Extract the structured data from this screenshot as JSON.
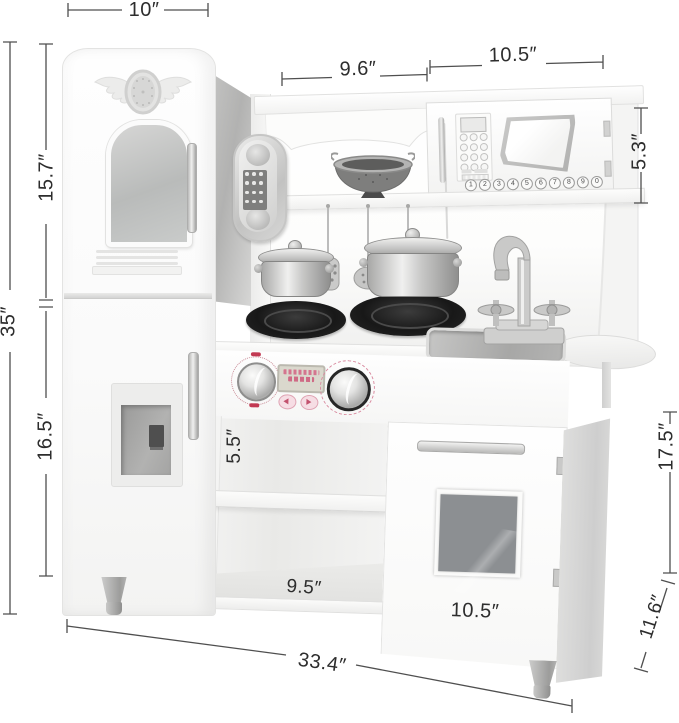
{
  "dimension_labels": {
    "fridge_top_width": "10″",
    "hutch_left_width": "9.6″",
    "hutch_right_width": "10.5″",
    "microwave_height": "5.3″",
    "total_height": "35″",
    "fridge_upper_height": "15.7″",
    "fridge_lower_height": "16.5″",
    "open_shelf_height": "5.5″",
    "open_shelf_width": "9.5″",
    "cabinet_door_width": "10.5″",
    "right_cabinet_height": "17.5″",
    "depth": "11.6″",
    "total_width": "33.4″"
  },
  "microwave": {
    "keypad_digits": [
      "1",
      "2",
      "3",
      "4",
      "5",
      "6",
      "7",
      "8",
      "9",
      "0"
    ]
  },
  "colors": {
    "dimension_line": "#4f4f4f",
    "dimension_text": "#2d2d2d",
    "accent_pink": "#d4758e",
    "burner_black": "#1c1c1c",
    "heart_glass_gray": "#8c8f92",
    "metal_silver": "#c6c6c5"
  }
}
